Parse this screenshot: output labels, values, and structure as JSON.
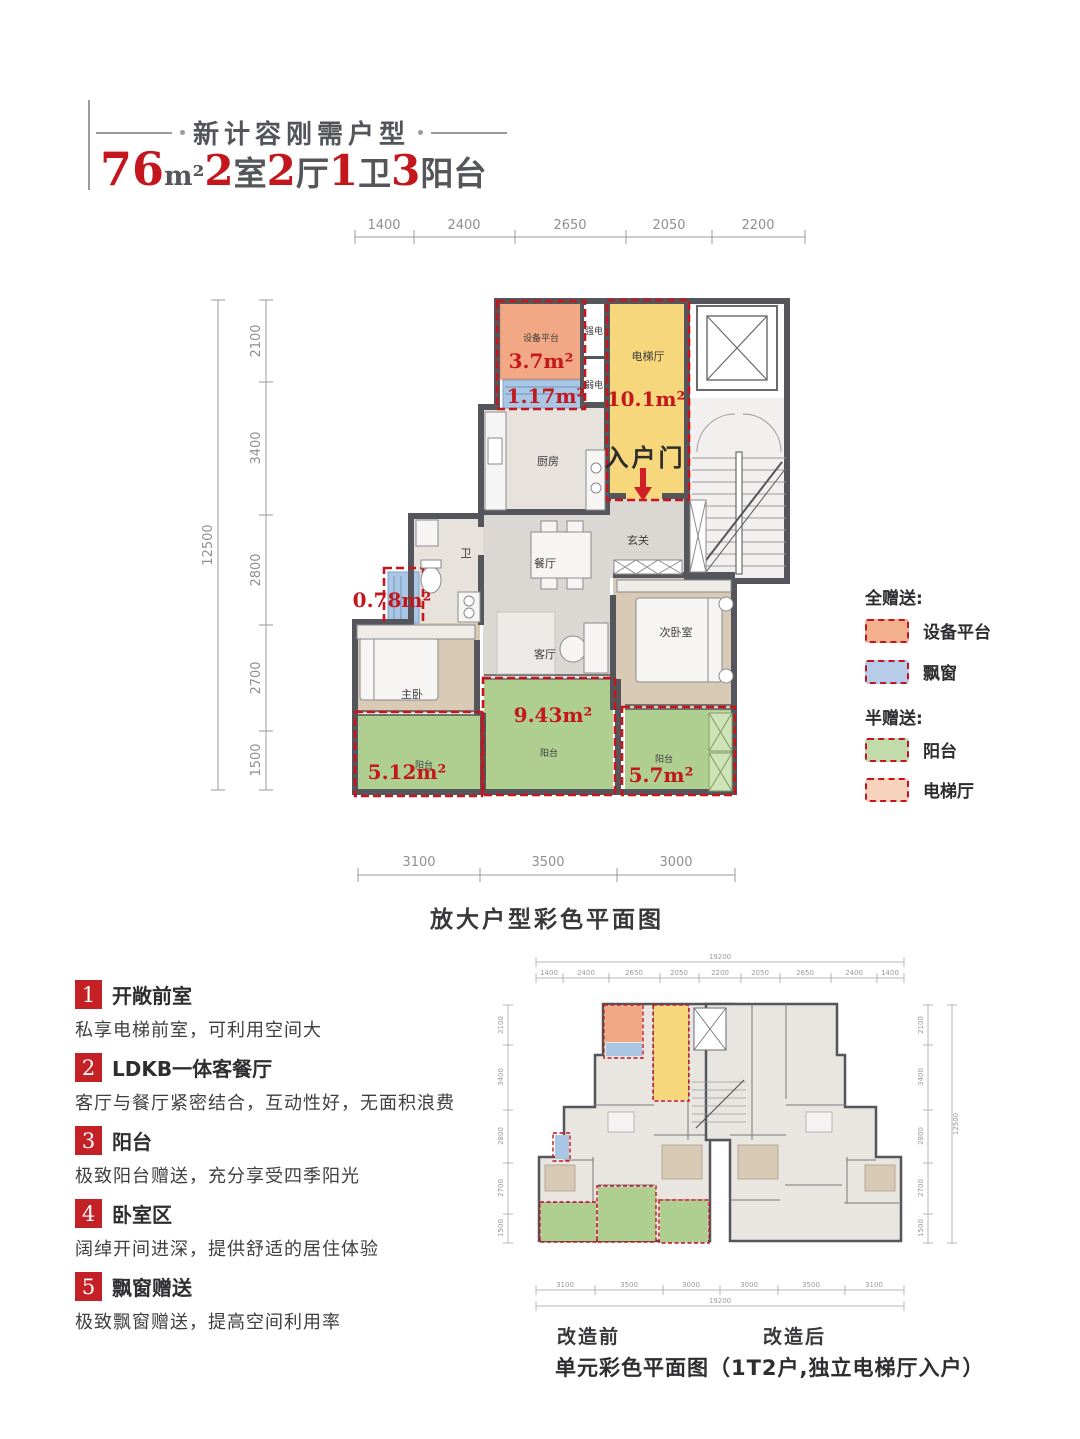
{
  "header": {
    "tagline": "新计容刚需户型",
    "spec": [
      {
        "num": "76",
        "unit": "m²"
      },
      {
        "num": "2",
        "unit": "室"
      },
      {
        "num": "2",
        "unit": "厅"
      },
      {
        "num": "1",
        "unit": "卫"
      },
      {
        "num": "3",
        "unit": "阳台"
      }
    ]
  },
  "main_plan": {
    "caption": "放大户型彩色平面图",
    "dims_top": [
      "1400",
      "2400",
      "2650",
      "2050",
      "2200"
    ],
    "dims_left_total": "12500",
    "dims_left": [
      "2100",
      "3400",
      "2800",
      "2700",
      "1500"
    ],
    "dims_bottom": [
      "3100",
      "3500",
      "3000"
    ],
    "rooms": {
      "equipment": "设备平台",
      "strong_elec": "强电",
      "weak_elec": "弱电",
      "elevator_hall": "电梯厅",
      "entry_door": "入户门",
      "kitchen": "厨房",
      "foyer": "玄关",
      "bath": "卫",
      "dining": "餐厅",
      "living": "客厅",
      "bedroom2": "次卧室",
      "master": "主卧",
      "balcony": "阳台"
    },
    "areas": {
      "equipment": "3.7m²",
      "bay1": "1.17m²",
      "elevator_hall": "10.1m²",
      "bay2": "0.78m²",
      "balcony_mid": "9.43m²",
      "balcony_left": "5.12m²",
      "balcony_right": "5.7m²"
    }
  },
  "legend": {
    "full_title": "全赠送:",
    "half_title": "半赠送:",
    "full_items": [
      {
        "label": "设备平台",
        "color": "#f2b18c"
      },
      {
        "label": "飘窗",
        "color": "#b6cce8"
      }
    ],
    "half_items": [
      {
        "label": "阳台",
        "color": "#c2dbaa"
      },
      {
        "label": "电梯厅",
        "color": "#f7d3bd"
      }
    ]
  },
  "features": [
    {
      "num": "1",
      "title": "开敞前室",
      "desc": "私享电梯前室，可利用空间大"
    },
    {
      "num": "2",
      "title": "LDKB一体客餐厅",
      "desc": "客厅与餐厅紧密结合，互动性好，无面积浪费"
    },
    {
      "num": "3",
      "title": "阳台",
      "desc": "极致阳台赠送，充分享受四季阳光"
    },
    {
      "num": "4",
      "title": "卧室区",
      "desc": "阔绰开间进深，提供舒适的居住体验"
    },
    {
      "num": "5",
      "title": "飘窗赠送",
      "desc": "极致飘窗赠送，提高空间利用率"
    }
  ],
  "unit_plan": {
    "caption": "单元彩色平面图（1T2户,独立电梯厅入户）",
    "before_label": "改造前",
    "after_label": "改造后",
    "dims_top_total": "19200",
    "dims_top": [
      "1400",
      "2400",
      "2650",
      "2050",
      "2200",
      "2050",
      "2650",
      "2400",
      "1400"
    ],
    "dims_bottom": [
      "3100",
      "3500",
      "3000",
      "3000",
      "3500",
      "3100"
    ],
    "dims_bottom_total": "19200",
    "dims_side": [
      "2100",
      "3400",
      "2800",
      "2700",
      "1500"
    ],
    "dims_side_total": "12500"
  },
  "colors": {
    "accent_red": "#c4161d",
    "equipment_fill": "#f2a884",
    "elevator_hall_fill": "#f6d77c",
    "bay_window_fill": "#a9c6e4",
    "balcony_fill": "#aecf90",
    "wall": "#55565b"
  }
}
